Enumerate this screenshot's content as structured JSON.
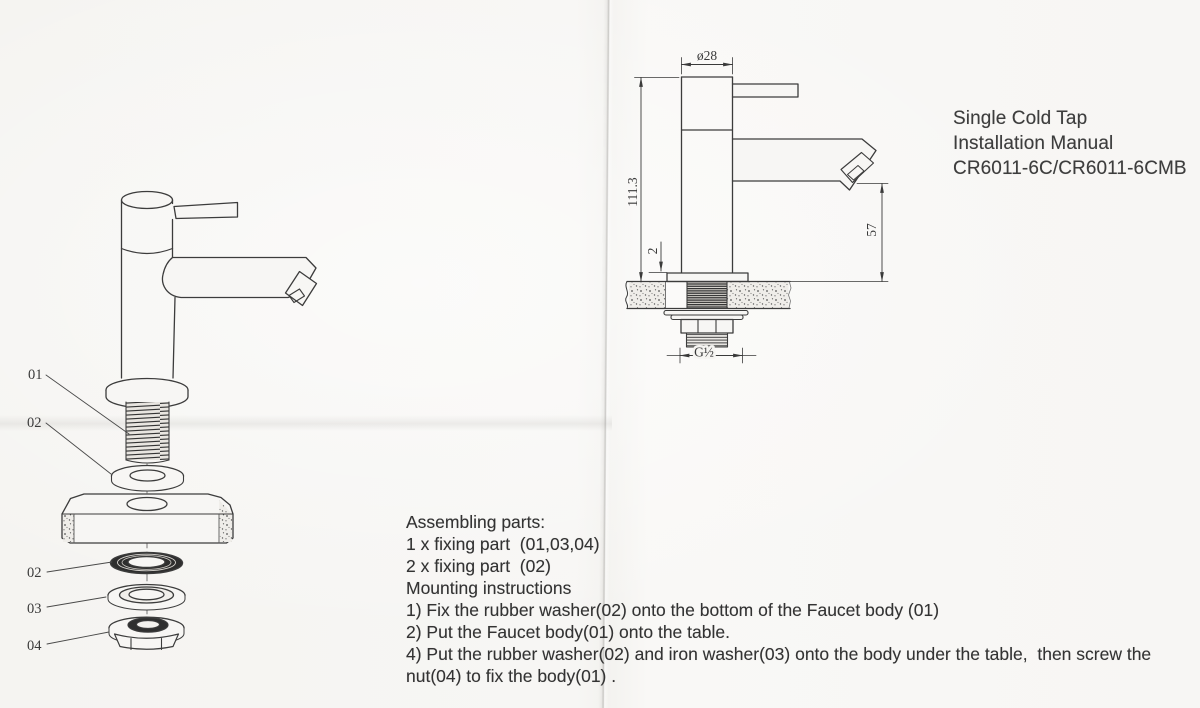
{
  "title_block": {
    "lines": [
      "Single Cold Tap",
      "Installation Manual",
      "CR6011-6C/CR6011-6CMB"
    ]
  },
  "assembly": {
    "heading": "Assembling parts:",
    "items": [
      "1 x fixing part  (01,03,04)",
      "2 x fixing part  (02)"
    ],
    "mounting_heading": "Mounting instructions",
    "steps": [
      "1) Fix the rubber washer(02) onto the bottom of the Faucet body (01)",
      "2) Put the Faucet body(01) onto the table.",
      "4) Put the rubber washer(02) and iron washer(03) onto the body under the table,  then screw the nut(04) to fix the body(01) ."
    ]
  },
  "exploded_view": {
    "part_labels": [
      "01",
      "02",
      "02",
      "03",
      "04"
    ],
    "part_names": [
      "faucet body",
      "rubber washer (top)",
      "rubber washer (bottom)",
      "iron washer",
      "nut"
    ]
  },
  "installed_view": {
    "dimensions": {
      "diameter": "ø28",
      "height": "111.3",
      "flange_thickness": "2",
      "spout_height": "57",
      "thread": "G½"
    }
  },
  "colors": {
    "paper": "#f7f6f4",
    "ink": "#383838",
    "drawing_line": "#3c3c3c"
  }
}
